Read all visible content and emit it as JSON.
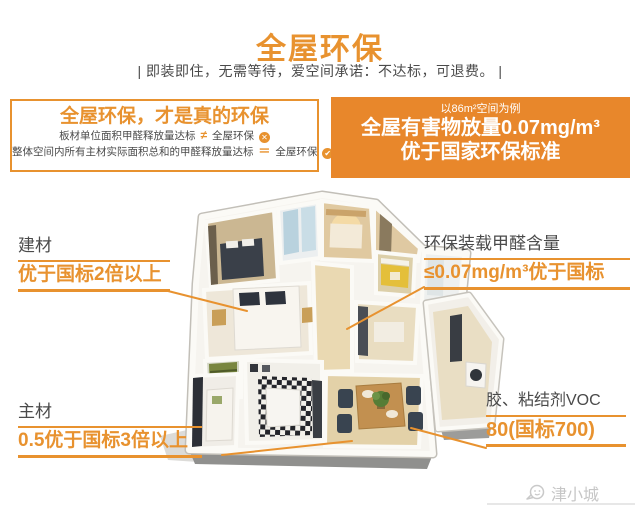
{
  "colors": {
    "accent": "#E8922F",
    "accent_dark_bg": "#E8872B",
    "text_dark": "#4A4A4A",
    "watermark_gray": "#C6C6C6"
  },
  "header": {
    "title": "全屋环保",
    "subtitle": "|  即装即住，无需等待，爱空间承诺：不达标，可退费。 |"
  },
  "claim_box": {
    "title": "全屋环保，才是真的环保",
    "lines": [
      {
        "text": "板材单位面积甲醛释放量达标",
        "operator": "≠",
        "target": "全屋环保",
        "mark": "✕"
      },
      {
        "text": "整体空间内所有主材实际面积总和的甲醛释放量达标",
        "operator": "＝",
        "target": "全屋环保",
        "mark": "✔"
      }
    ]
  },
  "stat_box": {
    "note": "以86m²空间为例",
    "line1": "全屋有害物放量0.07mg/m³",
    "line2": "优于国家环保标准"
  },
  "callouts": [
    {
      "title": "建材",
      "value": "优于国标2倍以上"
    },
    {
      "title": "主材",
      "value": "0.5优于国标3倍以上"
    },
    {
      "title": "环保装载甲醛含量",
      "value": "≤0.07mg/m³优于国标"
    },
    {
      "title": "胶、粘结剂VOC",
      "value": "80(国标700)"
    }
  ],
  "watermark": {
    "label": "津小城"
  }
}
